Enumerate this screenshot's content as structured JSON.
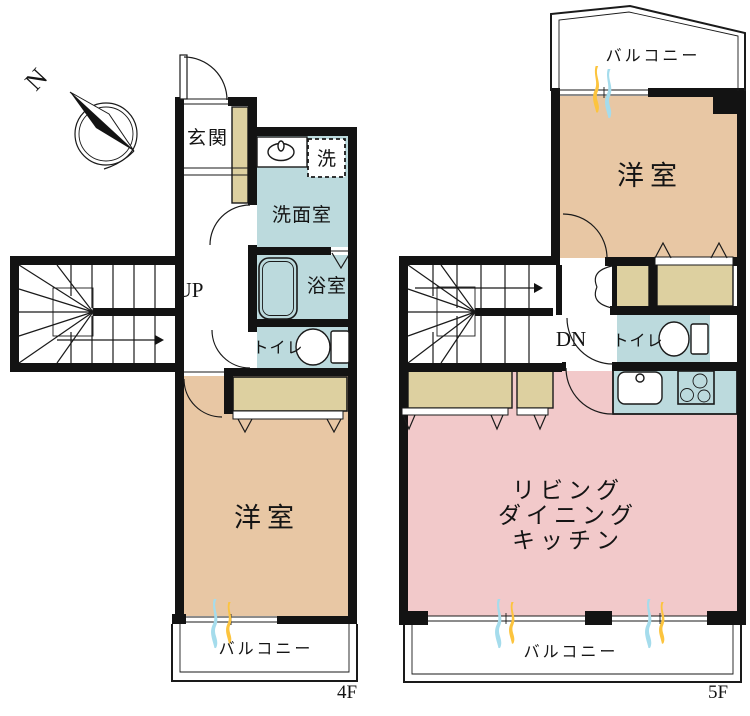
{
  "colors": {
    "wall": "#131313",
    "room_tan": "#e8c7a4",
    "room_pink": "#f2c9ca",
    "wet_teal": "#bcdadd",
    "closet_beige": "#ddd0a0",
    "curtain_yellow": "#fcc43e",
    "curtain_blue": "#a5dcec",
    "white": "#ffffff"
  },
  "compass": {
    "north_label": "N"
  },
  "floor_4f": {
    "floor_label": "4F",
    "stair_label": "UP",
    "rooms": {
      "entrance": "玄関",
      "laundry": "洗",
      "washroom": "洗面室",
      "bathroom": "浴室",
      "toilet": "トイレ",
      "western_room": "洋室",
      "balcony": "バルコニー"
    }
  },
  "floor_5f": {
    "floor_label": "5F",
    "stair_label": "DN",
    "rooms": {
      "western_room": "洋室",
      "toilet": "トイレ",
      "ldk": [
        "リビング",
        "ダイニング",
        "キッチン"
      ],
      "balcony_top": "バルコニー",
      "balcony_bottom": "バルコニー"
    }
  }
}
